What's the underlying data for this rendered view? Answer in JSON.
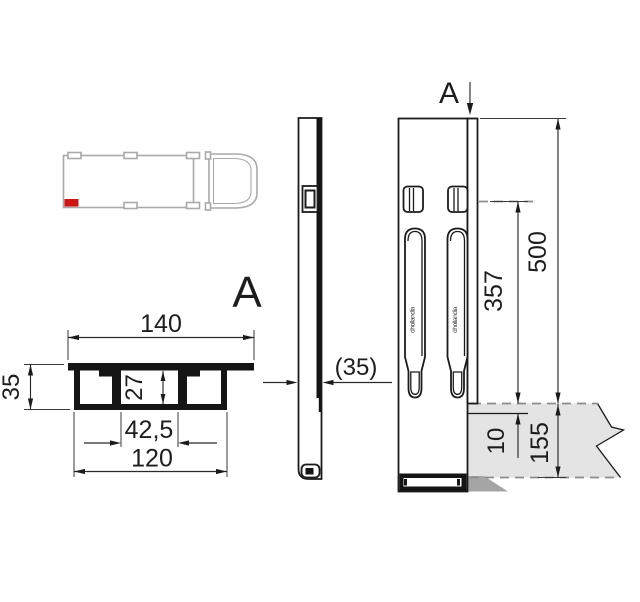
{
  "labels": {
    "section_view": "A",
    "section_cut": "A"
  },
  "cross_section": {
    "dim_top_width": "140",
    "dim_height": "35",
    "dim_inner_height": "27",
    "dim_mid_width": "42,5",
    "dim_bottom_width": "120"
  },
  "side_view": {
    "dim_thickness": "(35)"
  },
  "front_view": {
    "dim_total_height": "500",
    "dim_slot_center_to_platform": "357",
    "dim_step": "10",
    "dim_platform_height": "155",
    "handle_logo": "dhollandia"
  },
  "colors": {
    "marker_red": "#cc1616",
    "platform_fill": "#e4e4e4",
    "shadow_fill": "#a5a5a5"
  }
}
